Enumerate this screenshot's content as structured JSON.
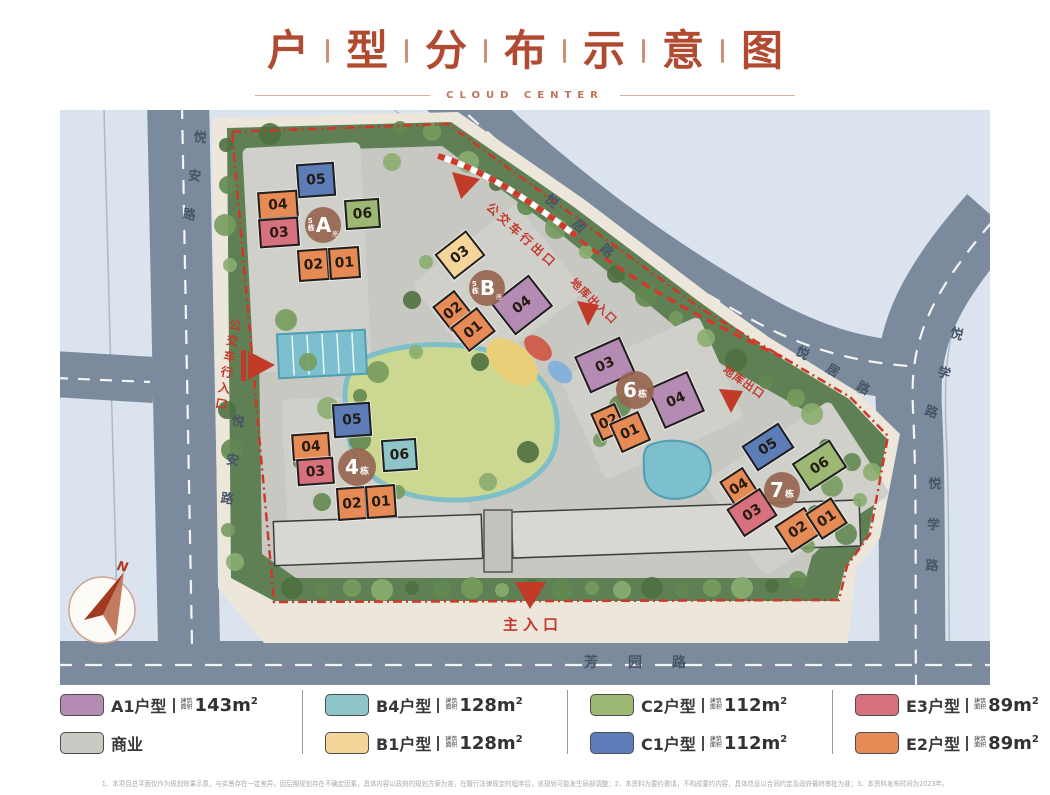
{
  "title": {
    "chars": [
      "户",
      "型",
      "分",
      "布",
      "示",
      "意",
      "图"
    ],
    "subtitle": "CLOUD CENTER"
  },
  "map": {
    "road_labels": [
      {
        "id": "yuean-road-upper",
        "text": "悦安路"
      },
      {
        "id": "yuean-road-lower",
        "text": "悦安路"
      },
      {
        "id": "yueju-road-top",
        "text": "悦居路"
      },
      {
        "id": "yueju-road-right",
        "text": "悦居路"
      },
      {
        "id": "yuexue-road-upper",
        "text": "悦学路"
      },
      {
        "id": "yuexue-road-lower",
        "text": "悦学路"
      },
      {
        "id": "fangyuan-road",
        "text": "芳园路"
      }
    ],
    "entrances": [
      {
        "id": "bus-exit",
        "text": "公交车行出口"
      },
      {
        "id": "garage-entrance-exit",
        "text": "地库出入口"
      },
      {
        "id": "garage-exit",
        "text": "地库出口"
      },
      {
        "id": "bus-entrance",
        "text": "公交车行入口"
      },
      {
        "id": "main-entrance",
        "text": "主入口"
      }
    ],
    "compass_label": "N",
    "unit_colors": {
      "A1": "#b48cb3",
      "B4": "#8ec5ca",
      "B1": "#f4d59a",
      "C2": "#9cb873",
      "C1": "#5c7db7",
      "E3": "#d8717e",
      "E2": "#e68b55",
      "COM": "#cac9c3"
    },
    "buildings": [
      {
        "id": "5a",
        "name": "5栋A座",
        "circle": {
          "small_top": "5",
          "small_bottom": "栋",
          "big": "A",
          "small_right": "座"
        },
        "units": [
          {
            "no": "05",
            "type": "C1"
          },
          {
            "no": "04",
            "type": "E2"
          },
          {
            "no": "03",
            "type": "E3"
          },
          {
            "no": "06",
            "type": "C2"
          },
          {
            "no": "02",
            "type": "E2"
          },
          {
            "no": "01",
            "type": "E2"
          }
        ]
      },
      {
        "id": "5b",
        "name": "5栋B座",
        "circle": {
          "small_top": "5",
          "small_bottom": "栋",
          "big": "B",
          "small_right": "座"
        },
        "units": [
          {
            "no": "03",
            "type": "B1"
          },
          {
            "no": "04",
            "type": "A1"
          },
          {
            "no": "02",
            "type": "E2"
          },
          {
            "no": "01",
            "type": "E2"
          }
        ]
      },
      {
        "id": "6",
        "name": "6栋",
        "circle": {
          "big": "6",
          "small_right": "栋"
        },
        "units": [
          {
            "no": "03",
            "type": "A1"
          },
          {
            "no": "04",
            "type": "A1"
          },
          {
            "no": "02",
            "type": "E2"
          },
          {
            "no": "01",
            "type": "E2"
          }
        ]
      },
      {
        "id": "4",
        "name": "4栋",
        "circle": {
          "big": "4",
          "small_right": "栋"
        },
        "units": [
          {
            "no": "05",
            "type": "C1"
          },
          {
            "no": "04",
            "type": "E2"
          },
          {
            "no": "03",
            "type": "E3"
          },
          {
            "no": "06",
            "type": "B4"
          },
          {
            "no": "02",
            "type": "E2"
          },
          {
            "no": "01",
            "type": "E2"
          }
        ]
      },
      {
        "id": "7",
        "name": "7栋",
        "circle": {
          "big": "7",
          "small_right": "栋"
        },
        "units": [
          {
            "no": "05",
            "type": "C1"
          },
          {
            "no": "06",
            "type": "C2"
          },
          {
            "no": "04",
            "type": "E2"
          },
          {
            "no": "03",
            "type": "E3"
          },
          {
            "no": "02",
            "type": "E2"
          },
          {
            "no": "01",
            "type": "E2"
          }
        ]
      }
    ]
  },
  "legend": {
    "area_label_lines": [
      "建筑",
      "面积"
    ],
    "area_unit": "m",
    "area_sup": "2",
    "columns": [
      [
        {
          "type": "A1",
          "label": "A1户型",
          "area": "143"
        },
        {
          "type": "COM",
          "label": "商业"
        }
      ],
      [
        {
          "type": "B4",
          "label": "B4户型",
          "area": "128"
        },
        {
          "type": "B1",
          "label": "B1户型",
          "area": "128"
        }
      ],
      [
        {
          "type": "C2",
          "label": "C2户型",
          "area": "112"
        },
        {
          "type": "C1",
          "label": "C1户型",
          "area": "112"
        }
      ],
      [
        {
          "type": "E3",
          "label": "E3户型",
          "area": "89"
        },
        {
          "type": "E2",
          "label": "E2户型",
          "area": "89"
        }
      ]
    ]
  },
  "footer": {
    "disclaimer": "1、本项目总平面仅作为规划效果示意，与实景存在一定差异，因后期规划存在不确定因素，具体内容以政府的规划方案为准，在履行法律规定的程序后，该规划可能发生局部调整；2、本资料为要约邀请，不构成要约内容，具体信息以合同约定及政府最终审批为准；3、本资料发布时间为2023年。"
  }
}
